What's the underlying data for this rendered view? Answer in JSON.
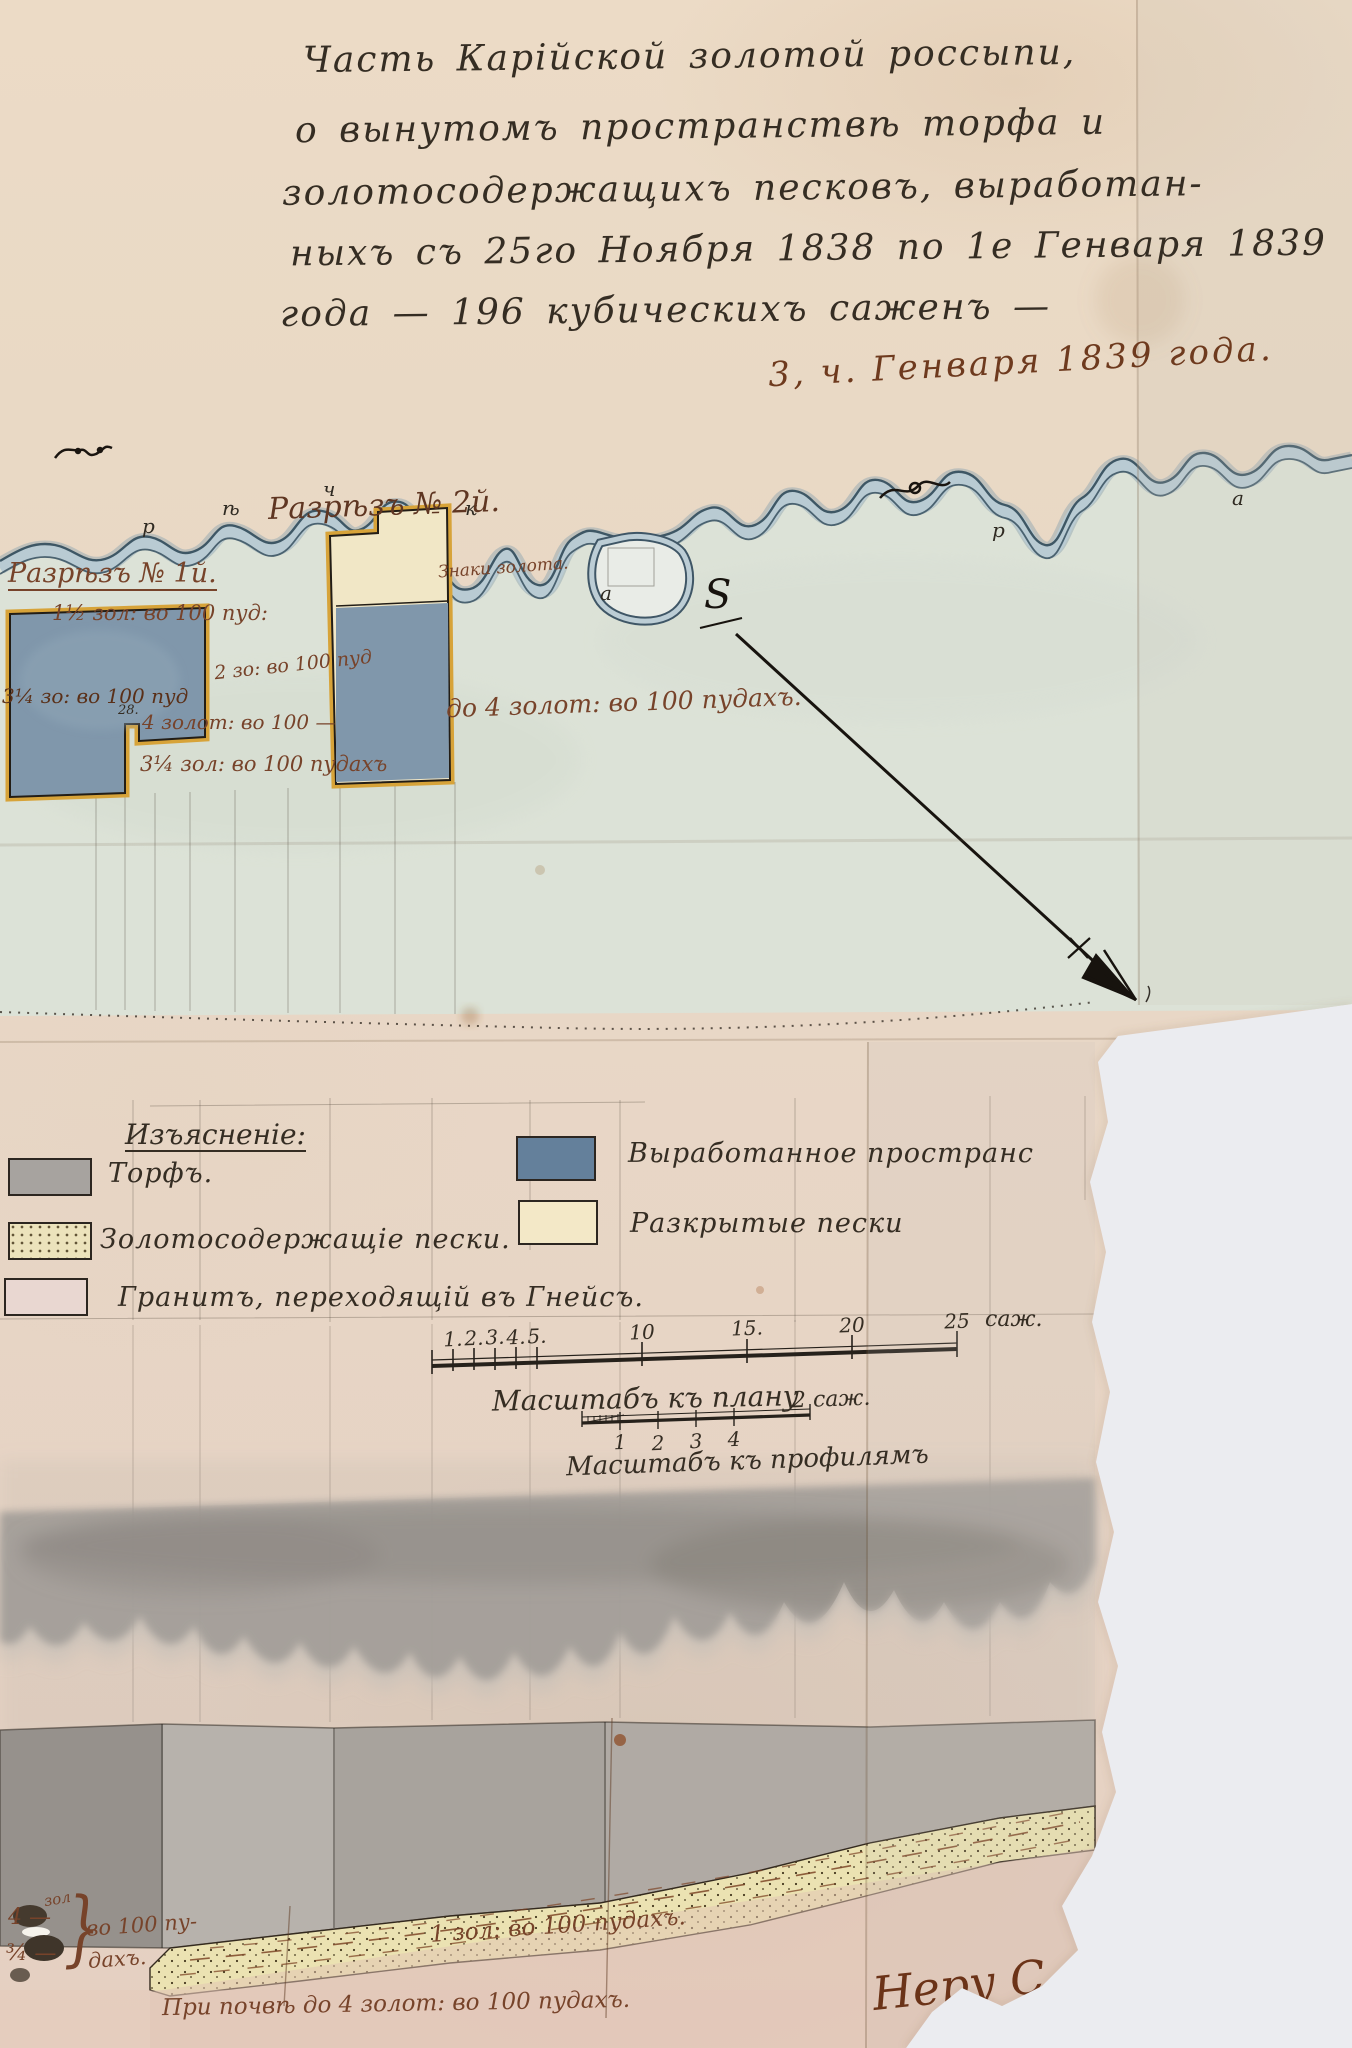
{
  "document": {
    "title_lines": [
      "Часть Карійской золотой россыпи,",
      "о вынутомъ пространствѣ торфа и",
      "золотосодержащихъ песковъ, выработан-",
      "ныхъ съ 25го Ноября 1838 по 1е Генваря 1839",
      "года — 196 кубическихъ саженъ —"
    ],
    "date_note": "3, ч. Генваря 1839 года."
  },
  "plan": {
    "river_letters": [
      "р",
      "ѣ",
      "ч",
      "к",
      "а",
      "р",
      "а"
    ],
    "origin_mark": "S",
    "section1_label": "Разрѣзъ № 1й.",
    "section1_grade": "1½ зол: во 100 пуд:",
    "section2_label": "Разрѣзъ № 2й.",
    "gold_signs": "Знаки золота.",
    "grade_on_block": "3¼ зо: во 100 пуд",
    "notch_number": "28.",
    "grade_mid": "4 золот: во 100 —",
    "grade_lower": "3¼ зол: во 100 пудахъ",
    "grade_upper": "2 зо: во 100 пуд",
    "grade_range": "до 4 золот: во 100 пудахъ."
  },
  "legend": {
    "header": "Изъясненіе:",
    "left": [
      {
        "swatch": "torf",
        "label": "Торфъ."
      },
      {
        "swatch": "gold-sands",
        "label": "Золотосодержащіе пески."
      },
      {
        "swatch": "granite",
        "label": "Гранитъ, переходящій въ Гнейсъ."
      }
    ],
    "right": [
      {
        "swatch": "worked-space",
        "label": "Выработанное пространс"
      },
      {
        "swatch": "opened-sands",
        "label": "Разкрытые пески"
      }
    ]
  },
  "scales": {
    "plan": {
      "ticks": [
        "1.",
        "2.",
        "3.",
        "4.",
        "5.",
        "10",
        "15.",
        "20",
        "25"
      ],
      "unit": "саж.",
      "caption": "Масштабъ къ плану"
    },
    "profile": {
      "ticks": [
        "1",
        "2",
        "3",
        "4"
      ],
      "end_label": "2 саж.",
      "caption": "Масштабъ къ профилямъ"
    }
  },
  "profile": {
    "grade_top_small": "зол",
    "grade_top": "4 —",
    "grade_bottom": "¾ —",
    "brace": "}",
    "per100": "во 100 пу-",
    "per100b": "дахъ.",
    "sand_grade": "1 зол: во 100 пудахъ.",
    "bottom_note": "При почвѣ до 4 золот: во 100 пудахъ.",
    "signature": "Неру Сли"
  },
  "colors": {
    "paper": "#e9d9c5",
    "valley_wash": "#dce2d7",
    "river_blue": "#b9cbd3",
    "river_outline": "#3e5765",
    "worked_blue": "#8097ab",
    "opened_cream": "#f1e7c6",
    "ochre_border": "#d7a339",
    "brown_ink": "#77432a",
    "black_ink": "#352d23",
    "torf_gray": "#a7a39f"
  }
}
